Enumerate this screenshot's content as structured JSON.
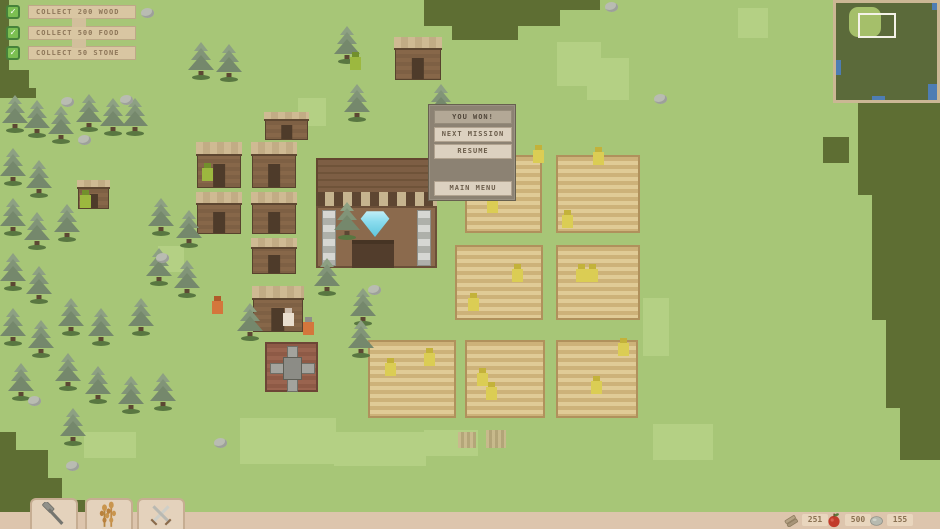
{
  "hud": {
    "check_glyph": "✓",
    "quests": [
      {
        "label": "COLLECT 200 WOOD",
        "checked": true
      },
      {
        "label": "COLLECT 500 FOOD",
        "checked": true
      },
      {
        "label": "COLLECT 50 STONE",
        "checked": true
      }
    ],
    "resources": [
      {
        "name": "wood",
        "icon": "wood-logs-icon",
        "value": "251"
      },
      {
        "name": "food",
        "icon": "apple-icon",
        "value": "500"
      },
      {
        "name": "stone",
        "icon": "stone-icon",
        "value": "155"
      }
    ],
    "toolbar": [
      {
        "name": "build",
        "icon": "hammer-icon"
      },
      {
        "name": "farm",
        "icon": "wheat-icon"
      },
      {
        "name": "military",
        "icon": "crossed-swords-icon"
      }
    ]
  },
  "dialog": {
    "title": "YOU WON!",
    "buttons": [
      {
        "label": "NEXT MISSION"
      },
      {
        "label": "RESUME"
      },
      {
        "label": "MAIN MENU"
      }
    ]
  },
  "colors": {
    "grass": "#a7c677",
    "grass_light": "#b4d084",
    "terrain_dark": "#5e6e33",
    "banner_tan": "#d9c6a2",
    "checkbox_green": "#7cbf52",
    "dialog_panel": "#8c8273",
    "dialog_button": "#dcd1c0",
    "apple_red": "#c23b2a",
    "diamond_cyan": "#8adcee",
    "bottom_bar": "#ddc5ad"
  },
  "world": {
    "terrain_dark": [
      [
        0,
        0,
        9,
        98
      ],
      [
        9,
        70,
        20,
        28
      ],
      [
        28,
        88,
        8,
        10
      ],
      [
        424,
        0,
        136,
        26
      ],
      [
        452,
        26,
        66,
        14
      ],
      [
        560,
        0,
        40,
        10
      ],
      [
        845,
        55,
        30,
        48
      ],
      [
        858,
        103,
        82,
        92
      ],
      [
        872,
        195,
        68,
        125
      ],
      [
        886,
        320,
        54,
        88
      ],
      [
        900,
        408,
        40,
        52
      ],
      [
        823,
        137,
        26,
        26
      ],
      [
        0,
        432,
        16,
        80
      ],
      [
        0,
        450,
        48,
        62
      ],
      [
        0,
        478,
        62,
        34
      ],
      [
        0,
        500,
        85,
        12
      ]
    ],
    "terrain_light": [
      [
        557,
        42,
        44,
        44
      ],
      [
        587,
        58,
        42,
        42
      ],
      [
        298,
        98,
        28,
        28
      ],
      [
        158,
        246,
        26,
        26
      ],
      [
        240,
        418,
        96,
        46
      ],
      [
        334,
        432,
        92,
        34
      ],
      [
        424,
        430,
        54,
        26
      ],
      [
        84,
        432,
        52,
        26
      ],
      [
        643,
        298,
        26,
        58
      ],
      [
        738,
        8,
        30,
        30
      ],
      [
        653,
        424,
        60,
        36
      ]
    ],
    "farms": [
      [
        465,
        155,
        77,
        78
      ],
      [
        556,
        155,
        84,
        78
      ],
      [
        455,
        245,
        88,
        75
      ],
      [
        556,
        245,
        84,
        75
      ],
      [
        368,
        340,
        88,
        78
      ],
      [
        465,
        340,
        80,
        78
      ],
      [
        556,
        340,
        82,
        78
      ]
    ],
    "plot_markers": [
      [
        458,
        432,
        18,
        16
      ],
      [
        486,
        430,
        20,
        18
      ]
    ],
    "houses": [
      [
        197,
        142,
        44,
        46
      ],
      [
        197,
        192,
        44,
        42
      ],
      [
        252,
        142,
        44,
        46
      ],
      [
        252,
        192,
        44,
        42
      ],
      [
        252,
        238,
        44,
        36
      ],
      [
        253,
        286,
        50,
        46
      ],
      [
        395,
        37,
        46,
        43
      ],
      [
        78,
        180,
        31,
        29
      ],
      [
        265,
        112,
        43,
        28
      ]
    ],
    "trees": [
      [
        2,
        95
      ],
      [
        24,
        100
      ],
      [
        48,
        106
      ],
      [
        76,
        94
      ],
      [
        100,
        98
      ],
      [
        122,
        98
      ],
      [
        188,
        42
      ],
      [
        216,
        44
      ],
      [
        0,
        148
      ],
      [
        26,
        160
      ],
      [
        0,
        198
      ],
      [
        24,
        212
      ],
      [
        54,
        204
      ],
      [
        148,
        198
      ],
      [
        176,
        210
      ],
      [
        0,
        253
      ],
      [
        26,
        266
      ],
      [
        146,
        248
      ],
      [
        174,
        260
      ],
      [
        0,
        308
      ],
      [
        28,
        320
      ],
      [
        58,
        298
      ],
      [
        88,
        308
      ],
      [
        128,
        298
      ],
      [
        8,
        363
      ],
      [
        55,
        353
      ],
      [
        85,
        366
      ],
      [
        118,
        376
      ],
      [
        150,
        373
      ],
      [
        60,
        408
      ],
      [
        237,
        303
      ],
      [
        350,
        288
      ],
      [
        348,
        320
      ],
      [
        334,
        26
      ],
      [
        344,
        84
      ],
      [
        428,
        84
      ],
      [
        334,
        202
      ],
      [
        314,
        258
      ]
    ],
    "stones": [
      [
        28,
        396
      ],
      [
        66,
        461
      ],
      [
        141,
        8
      ],
      [
        61,
        97
      ],
      [
        78,
        135
      ],
      [
        120,
        95
      ],
      [
        368,
        285
      ],
      [
        654,
        94
      ],
      [
        605,
        2
      ],
      [
        214,
        438
      ],
      [
        156,
        253
      ],
      [
        448,
        117
      ]
    ],
    "villagers": [
      [
        350,
        52,
        "green"
      ],
      [
        202,
        163,
        "green"
      ],
      [
        80,
        190,
        "green"
      ],
      [
        212,
        296,
        "orange"
      ],
      [
        283,
        308,
        "pale"
      ],
      [
        303,
        317,
        "orange-hat"
      ],
      [
        533,
        145,
        "yellow"
      ],
      [
        593,
        147,
        "yellow"
      ],
      [
        487,
        195,
        "yellow"
      ],
      [
        562,
        210,
        "yellow"
      ],
      [
        512,
        264,
        "yellow"
      ],
      [
        576,
        264,
        "yellow"
      ],
      [
        587,
        264,
        "yellow"
      ],
      [
        468,
        293,
        "yellow"
      ],
      [
        477,
        368,
        "yellow"
      ],
      [
        486,
        382,
        "yellow"
      ],
      [
        618,
        338,
        "yellow"
      ],
      [
        591,
        376,
        "yellow"
      ],
      [
        385,
        358,
        "yellow"
      ],
      [
        424,
        348,
        "yellow"
      ]
    ]
  }
}
